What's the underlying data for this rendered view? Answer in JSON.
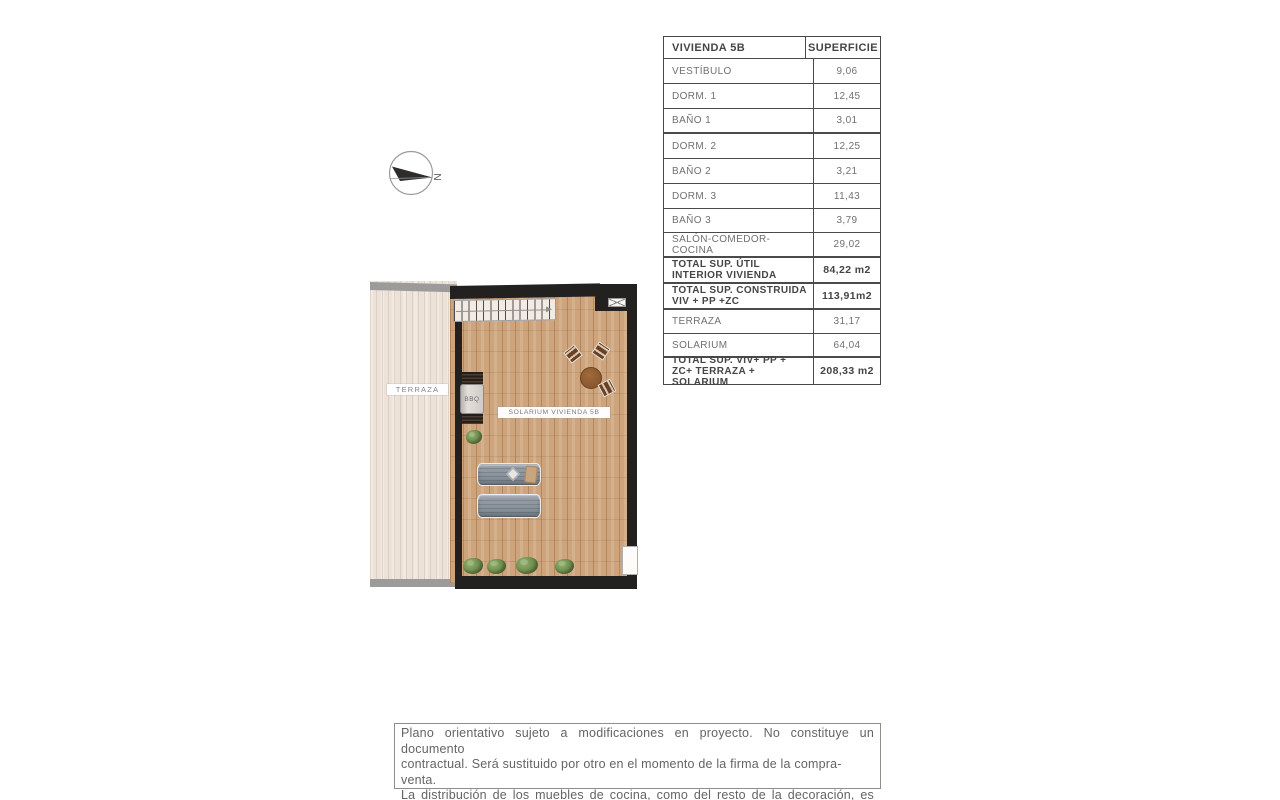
{
  "compass": {
    "north_label": "N"
  },
  "plan": {
    "terraza_label": "TERRAZA",
    "solarium_label": "SOLARIUM VIVIENDA 5B",
    "bbq_label": "BBQ"
  },
  "area_table": {
    "header": {
      "name": "VIVIENDA 5B",
      "area": "SUPERFICIE"
    },
    "rows": [
      {
        "label": "VESTÍBULO",
        "value": "9,06",
        "total": false
      },
      {
        "label": "DORM. 1",
        "value": "12,45",
        "total": false
      },
      {
        "label": "BAÑO 1",
        "value": "3,01",
        "total": false
      },
      {
        "label": "DORM. 2",
        "value": "12,25",
        "total": false
      },
      {
        "label": "BAÑO 2",
        "value": "3,21",
        "total": false
      },
      {
        "label": "DORM. 3",
        "value": "11,43",
        "total": false
      },
      {
        "label": "BAÑO 3",
        "value": "3,79",
        "total": false
      },
      {
        "label": "SALÓN-COMEDOR-COCINA",
        "value": "29,02",
        "total": false
      },
      {
        "label": "TOTAL SUP. ÚTIL INTERIOR VIVIENDA",
        "value": "84,22 m2",
        "total": true
      },
      {
        "label": "TOTAL SUP. CONSTRUIDA VIV + PP +ZC",
        "value": "113,91m2",
        "total": true
      },
      {
        "label": "TERRAZA",
        "value": "31,17",
        "total": false
      },
      {
        "label": "SOLARIUM",
        "value": "64,04",
        "total": false
      },
      {
        "label": "TOTAL SUP. VIV+ PP + ZC+ TERRAZA + SOLARIUM",
        "value": "208,33 m2",
        "total": true
      }
    ]
  },
  "disclaimer": {
    "lines": [
      "Plano orientativo sujeto a modificaciones en proyecto. No constituye un documento",
      "contractual. Será sustituido por otro en el momento de la firma de la compra-venta.",
      "La distribución de los muebles de cocina, como del resto de la decoración, es mera-",
      "mente orientativa."
    ]
  },
  "colors": {
    "wall": "#232020",
    "solarium_floor": "#cda47c",
    "terraza_floor": "#ece2d8",
    "table_border": "#4a4a4a",
    "text_gray": "#6f7072"
  }
}
